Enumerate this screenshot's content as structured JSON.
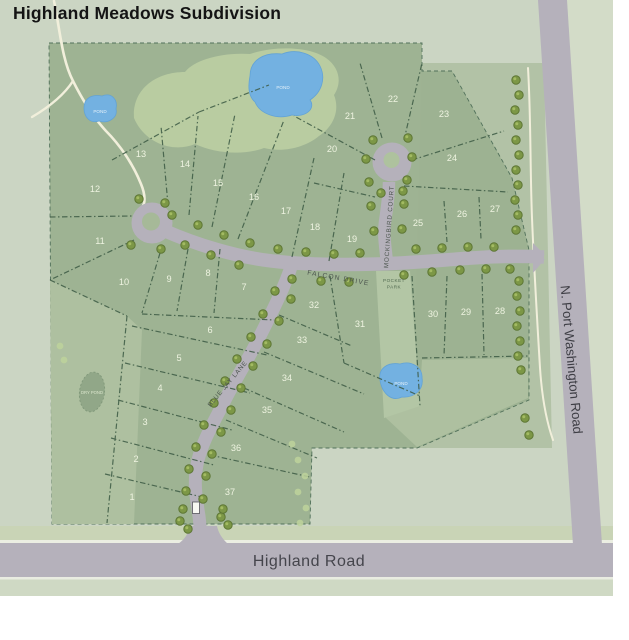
{
  "title": "Highland Meadows Subdivision",
  "roads": {
    "highland": {
      "label": "Highland Road"
    },
    "port_washington": {
      "label": "N. Port Washington Road"
    },
    "falcon": {
      "label": "FALCON DRIVE"
    },
    "mockingbird": {
      "label": "MOCKINGBIRD COURT"
    },
    "blue_jay": {
      "label": "BLUE JAY LANE"
    }
  },
  "features": {
    "pond_label": "POND",
    "dry_pond_label": "DRY POND",
    "pocket_park_label": "POCKET PARK"
  },
  "lots": [
    {
      "n": "1",
      "x": 140,
      "y": 532
    },
    {
      "n": "2",
      "x": 144,
      "y": 494
    },
    {
      "n": "3",
      "x": 153,
      "y": 457
    },
    {
      "n": "4",
      "x": 168,
      "y": 423
    },
    {
      "n": "5",
      "x": 187,
      "y": 393
    },
    {
      "n": "6",
      "x": 218,
      "y": 365
    },
    {
      "n": "7",
      "x": 252,
      "y": 322
    },
    {
      "n": "8",
      "x": 216,
      "y": 308
    },
    {
      "n": "9",
      "x": 177,
      "y": 314
    },
    {
      "n": "10",
      "x": 132,
      "y": 317
    },
    {
      "n": "11",
      "x": 108,
      "y": 276
    },
    {
      "n": "12",
      "x": 103,
      "y": 224
    },
    {
      "n": "13",
      "x": 149,
      "y": 189
    },
    {
      "n": "14",
      "x": 193,
      "y": 199
    },
    {
      "n": "15",
      "x": 226,
      "y": 218
    },
    {
      "n": "16",
      "x": 262,
      "y": 232
    },
    {
      "n": "17",
      "x": 294,
      "y": 246
    },
    {
      "n": "18",
      "x": 323,
      "y": 262
    },
    {
      "n": "19",
      "x": 360,
      "y": 274
    },
    {
      "n": "20",
      "x": 340,
      "y": 184
    },
    {
      "n": "21",
      "x": 358,
      "y": 151
    },
    {
      "n": "22",
      "x": 401,
      "y": 134
    },
    {
      "n": "23",
      "x": 452,
      "y": 149
    },
    {
      "n": "24",
      "x": 460,
      "y": 193
    },
    {
      "n": "25",
      "x": 426,
      "y": 258
    },
    {
      "n": "26",
      "x": 470,
      "y": 249
    },
    {
      "n": "27",
      "x": 503,
      "y": 244
    },
    {
      "n": "28",
      "x": 508,
      "y": 346
    },
    {
      "n": "29",
      "x": 474,
      "y": 347
    },
    {
      "n": "30",
      "x": 441,
      "y": 349
    },
    {
      "n": "31",
      "x": 368,
      "y": 359
    },
    {
      "n": "32",
      "x": 322,
      "y": 340
    },
    {
      "n": "33",
      "x": 310,
      "y": 375
    },
    {
      "n": "34",
      "x": 295,
      "y": 413
    },
    {
      "n": "35",
      "x": 275,
      "y": 445
    },
    {
      "n": "36",
      "x": 244,
      "y": 483
    },
    {
      "n": "37",
      "x": 238,
      "y": 527
    }
  ],
  "colors": {
    "map_background": "#cbd5c3",
    "parcel": "#9db292",
    "open_space": "#aec0a0",
    "tree_canopy": "#b9cca1",
    "road": "#b5b1bb",
    "pond": "#73b1e1",
    "trail": "#f1efdb",
    "lot_line": "#3c5a44",
    "lot_number": "#eef3e0",
    "road_label": "#45454c"
  }
}
